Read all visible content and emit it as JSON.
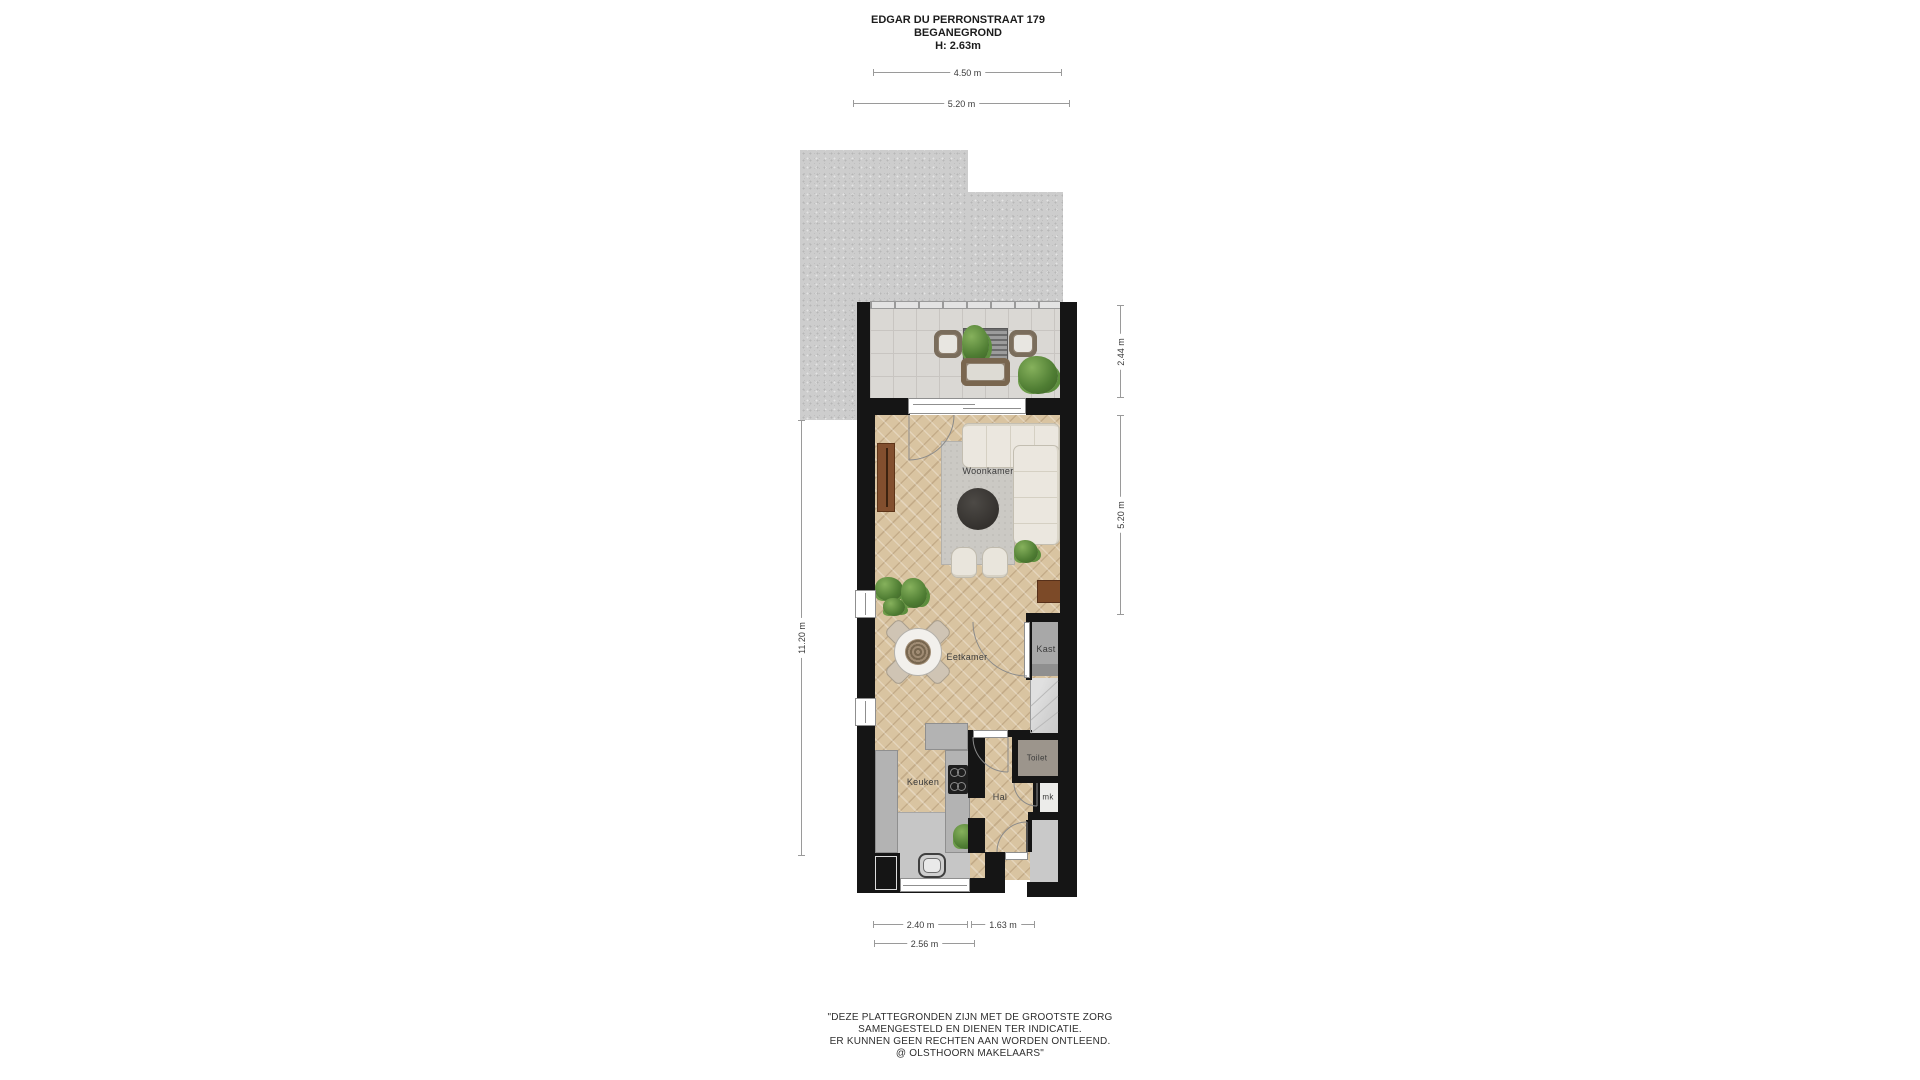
{
  "header": {
    "line1": "EDGAR DU PERRONSTRAAT 179",
    "line2": "BEGANEGROND",
    "line3": "H: 2.63m"
  },
  "rooms": {
    "woonkamer": "Woonkamer",
    "eetkamer": "Eetkamer",
    "keuken": "Keuken",
    "hal": "Hal",
    "toilet": "Toilet",
    "mk": "mk",
    "kast": "Kast"
  },
  "dimensions": {
    "terrace_width": "4.50 m",
    "terrace_outer_width": "5.20 m",
    "terrace_depth": "2.44 m",
    "living_depth": "5.20 m",
    "total_depth": "11.20 m",
    "kitchen_width": "2.40 m",
    "hall_width": "1.63 m",
    "front_width": "2.56 m"
  },
  "disclaimer": {
    "line1": "\"DEZE PLATTEGRONDEN ZIJN MET DE GROOTSTE ZORG",
    "line2": "SAMENGESTELD EN DIENEN TER INDICATIE.",
    "line3": "ER KUNNEN GEEN RECHTEN AAN WORDEN ONTLEEND.",
    "line4": "@ OLSTHOORN MAKELAARS\""
  },
  "colors": {
    "wall": "#151515",
    "wood_floor": "#d9c4a1",
    "terrace_tile": "#dad8d4",
    "gravel": "#cdcdcd",
    "counter_gray": "#b3b3b3",
    "rug": "#cbc9c4",
    "sofa": "#ebe7df",
    "plant_green": "#4f7d33",
    "cabinet_brown": "#824f2e",
    "closet_gray": "#a8a8a8",
    "toilet_floor": "#9c958c"
  }
}
